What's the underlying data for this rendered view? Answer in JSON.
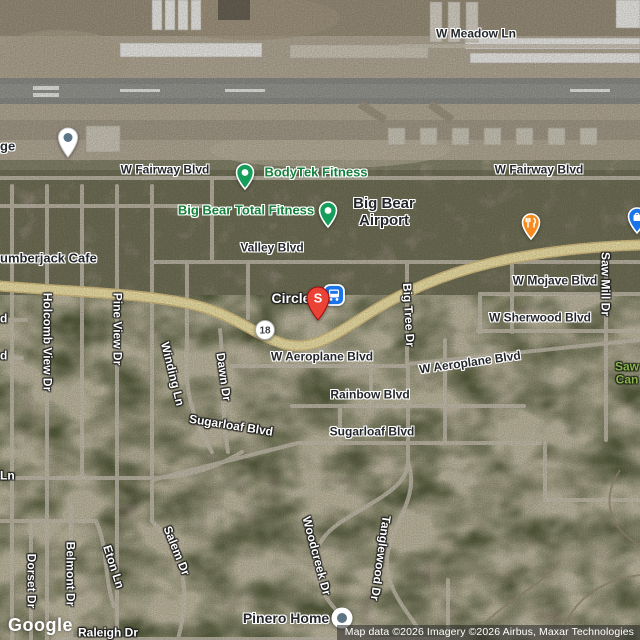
{
  "map": {
    "provider_logo": "Google",
    "attribution": "Map data ©2026 Imagery ©2026 Airbus, Maxar Technologies",
    "colors": {
      "route_yellow": "#f2e5a9",
      "route_casing": "#d8c184",
      "road_gray": "#c9c2b2",
      "poi_green": "#149e5a",
      "poi_green_text": "#15803b",
      "restaurant_orange": "#f78a1d",
      "transit_blue": "#1a73e8",
      "pin_red": "#ea4335",
      "marker_slate": "#5c7585",
      "park_text_green": "#8ab54e"
    },
    "street_labels": [
      {
        "id": "w-meadow-ln",
        "text": "W Meadow Ln",
        "x": 476,
        "y": 34,
        "tone": "dark",
        "size": 12
      },
      {
        "id": "w-fairway-blvd-west",
        "text": "W Fairway Blvd",
        "x": 165,
        "y": 170,
        "tone": "dark",
        "size": 12
      },
      {
        "id": "w-fairway-blvd-east",
        "text": "W Fairway Blvd",
        "x": 539,
        "y": 170,
        "tone": "dark",
        "size": 12
      },
      {
        "id": "valley-blvd",
        "text": "Valley Blvd",
        "x": 272,
        "y": 248,
        "tone": "dark",
        "size": 12
      },
      {
        "id": "w-mojave-blvd",
        "text": "W Mojave Blvd",
        "x": 555,
        "y": 281,
        "tone": "dark",
        "size": 12
      },
      {
        "id": "w-sherwood-blvd",
        "text": "W Sherwood Blvd",
        "x": 540,
        "y": 318,
        "tone": "dark",
        "size": 12
      },
      {
        "id": "w-aeroplane-blvd-west",
        "text": "W Aeroplane Blvd",
        "x": 322,
        "y": 357,
        "tone": "dark",
        "size": 12
      },
      {
        "id": "w-aeroplane-blvd-east",
        "text": "W Aeroplane Blvd",
        "x": 470,
        "y": 363,
        "rot": -8,
        "tone": "dark",
        "size": 12
      },
      {
        "id": "rainbow-blvd",
        "text": "Rainbow Blvd",
        "x": 370,
        "y": 395,
        "tone": "dark",
        "size": 12
      },
      {
        "id": "sugarloaf-blvd-east",
        "text": "Sugarloaf Blvd",
        "x": 372,
        "y": 432,
        "tone": "dark",
        "size": 12
      },
      {
        "id": "sugarloaf-blvd-west",
        "text": "Sugarloaf Blvd",
        "x": 231,
        "y": 426,
        "rot": 9,
        "tone": "light",
        "size": 12
      },
      {
        "id": "holcomb-view-dr",
        "text": "Holcomb View Dr",
        "x": 47,
        "y": 342,
        "rot": 90,
        "tone": "light",
        "size": 12
      },
      {
        "id": "pine-view-dr",
        "text": "Pine View Dr",
        "x": 117,
        "y": 329,
        "rot": 90,
        "tone": "light",
        "size": 12
      },
      {
        "id": "winding-ln",
        "text": "Winding Ln",
        "x": 172,
        "y": 374,
        "rot": 76,
        "tone": "light",
        "size": 12
      },
      {
        "id": "dawn-dr",
        "text": "Dawn Dr",
        "x": 223,
        "y": 377,
        "rot": 82,
        "tone": "light",
        "size": 12
      },
      {
        "id": "big-tree-dr",
        "text": "Big Tree Dr",
        "x": 408,
        "y": 315,
        "rot": 87,
        "tone": "light",
        "size": 12
      },
      {
        "id": "saw-mill-dr",
        "text": "Saw Mill Dr",
        "x": 605,
        "y": 284,
        "rot": 90,
        "tone": "light",
        "size": 12
      },
      {
        "id": "woodcreek-dr",
        "text": "Woodcreek Dr",
        "x": 316,
        "y": 556,
        "rot": 75,
        "tone": "light",
        "size": 12
      },
      {
        "id": "tanglewood-dr",
        "text": "Tanglewood Dr",
        "x": 380,
        "y": 558,
        "rot": 98,
        "tone": "light",
        "size": 12
      },
      {
        "id": "salem-dr",
        "text": "Salem Dr",
        "x": 176,
        "y": 551,
        "rot": 68,
        "tone": "light",
        "size": 12
      },
      {
        "id": "belmont-dr",
        "text": "Belmont Dr",
        "x": 70,
        "y": 574,
        "rot": 90,
        "tone": "light",
        "size": 12
      },
      {
        "id": "eton-ln",
        "text": "Eton Ln",
        "x": 113,
        "y": 567,
        "rot": 72,
        "tone": "light",
        "size": 12
      },
      {
        "id": "dorset-dr",
        "text": "Dorset Dr",
        "x": 31,
        "y": 581,
        "rot": 90,
        "tone": "light",
        "size": 12
      },
      {
        "id": "raleigh-dr",
        "text": "Raleigh Dr",
        "x": 108,
        "y": 633,
        "tone": "light",
        "size": 12
      },
      {
        "id": "ln-fragment",
        "text": "Ln",
        "x": 0,
        "y": 476,
        "anchor": "left",
        "tone": "light",
        "size": 12
      },
      {
        "id": "blvd-fragment-1",
        "text": "d",
        "x": 0,
        "y": 319,
        "anchor": "left",
        "tone": "light",
        "size": 12
      },
      {
        "id": "blvd-fragment-2",
        "text": "d",
        "x": 0,
        "y": 356,
        "anchor": "left",
        "tone": "light",
        "size": 12
      }
    ],
    "poi_labels": [
      {
        "id": "lumberjack-cafe",
        "text": "umberjack Cafe",
        "x": 0,
        "y": 259,
        "anchor": "left",
        "tone": "dark",
        "size": 13
      },
      {
        "id": "bodytek-fitness",
        "text": "BodyTek Fitness",
        "x": 316,
        "y": 173,
        "tone": "green",
        "size": 13
      },
      {
        "id": "big-bear-total-fitness",
        "text": "Big Bear Total Fitness",
        "x": 246,
        "y": 211,
        "tone": "green",
        "size": 13
      },
      {
        "id": "big-bear-airport",
        "lines": [
          "Big Bear",
          "Airport"
        ],
        "x": 384,
        "y": 213,
        "tone": "dark",
        "size": 15
      },
      {
        "id": "circle-s",
        "text": "Circle",
        "x": 291,
        "y": 299,
        "tone": "light",
        "size": 14
      },
      {
        "id": "pinero-home",
        "text": "Pinero Home",
        "x": 286,
        "y": 619,
        "tone": "dark",
        "size": 14
      },
      {
        "id": "storage-partial",
        "text": "ge",
        "x": 0,
        "y": 147,
        "anchor": "left",
        "tone": "dark",
        "size": 13
      },
      {
        "id": "sawmill-canyon-partial",
        "lines": [
          "Saw",
          "Can"
        ],
        "x": 615,
        "y": 374,
        "anchor": "left",
        "tone": "park",
        "size": 12
      }
    ],
    "markers": [
      {
        "id": "storage-pin",
        "kind": "pin-slate",
        "x": 68,
        "y": 137
      },
      {
        "id": "bodytek-icon",
        "kind": "poi-green",
        "x": 245,
        "y": 172
      },
      {
        "id": "total-fitness-icon",
        "kind": "poi-green",
        "x": 328,
        "y": 210
      },
      {
        "id": "restaurant-icon",
        "kind": "poi-orange",
        "x": 531,
        "y": 222
      },
      {
        "id": "shopping-icon",
        "kind": "poi-blue",
        "x": 637,
        "y": 216
      },
      {
        "id": "route-18-shield",
        "kind": "shield",
        "x": 265,
        "y": 330,
        "text": "18"
      },
      {
        "id": "bus-stop-icon",
        "kind": "transit",
        "x": 334,
        "y": 295
      },
      {
        "id": "selected-place-pin",
        "kind": "pin-red",
        "x": 318,
        "y": 298,
        "letter": "S"
      },
      {
        "id": "pinero-home-marker",
        "kind": "circle-dot",
        "x": 342,
        "y": 618
      }
    ]
  }
}
